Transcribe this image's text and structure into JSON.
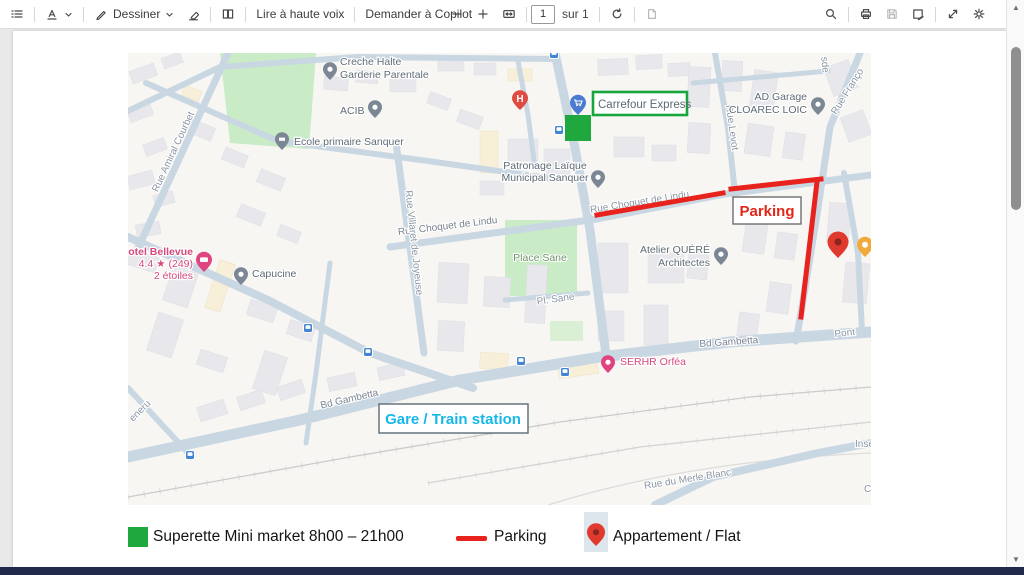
{
  "toolbar": {
    "draw_label": "Dessiner",
    "read_aloud_label": "Lire à haute voix",
    "copilot_label": "Demander à Copilot",
    "page_number": "1",
    "page_count_label": "sur 1"
  },
  "map": {
    "pois": {
      "creche_line1": "Creche Halte",
      "creche_line2": "Garderie Parentale",
      "acib": "ACIB",
      "ecole": "Ecole primaire Sanquer",
      "patronage_line1": "Patronage Laïque",
      "patronage_line2": "Municipal Sanquer",
      "atelier_line1": "Atelier QUÉRÉ",
      "atelier_line2": "Architectes",
      "garage_line1": "AD Garage",
      "garage_line2": "CLOAREC LOIC",
      "hotel_line1": "otel Bellevue",
      "hotel_line2": "4.4 ★ (249)",
      "hotel_line3": "2 étoiles",
      "capucine": "Capucine",
      "serhr": "SERHR Orféa"
    },
    "streets": {
      "amiral_courbet": "Rue Amiral Courbet",
      "choquet_w": "Rue Choquet de Lindu",
      "choquet_e": "Rue Choquet de Lindu",
      "villaret": "Rue Villaret de Joyeuse",
      "levot": "Rue Levot",
      "francois": "Rue Franço",
      "partial_ne": "sde",
      "place_sane": "Place Sane",
      "pl_sane": "Pl. Sane",
      "gambetta_w": "Bd Gambetta",
      "gambetta_e": "Bd Gambetta",
      "eneru": "eneru",
      "merle_blanc": "Rue du Merle Blanc",
      "inse": "Inse",
      "c_partial": "C",
      "pont": "Pont"
    }
  },
  "annotations": {
    "carrefour_label": "Carrefour Express",
    "parking_label": "Parking",
    "gare_label": "Gare / Train station"
  },
  "legend": {
    "superette": "Superette Mini market 8h00 – 21h00",
    "parking": "Parking",
    "appartement": "Appartement / Flat"
  },
  "colors": {
    "annotation_red": "#e8231d",
    "annotation_green": "#1fa83d",
    "gare_cyan": "#18b7e9",
    "parking_red": "#e02519",
    "road": "#c9d7e3",
    "park_green": "#c9ecc6",
    "pin_red": "#e03a2f",
    "taskbar_navy": "#20294a"
  }
}
